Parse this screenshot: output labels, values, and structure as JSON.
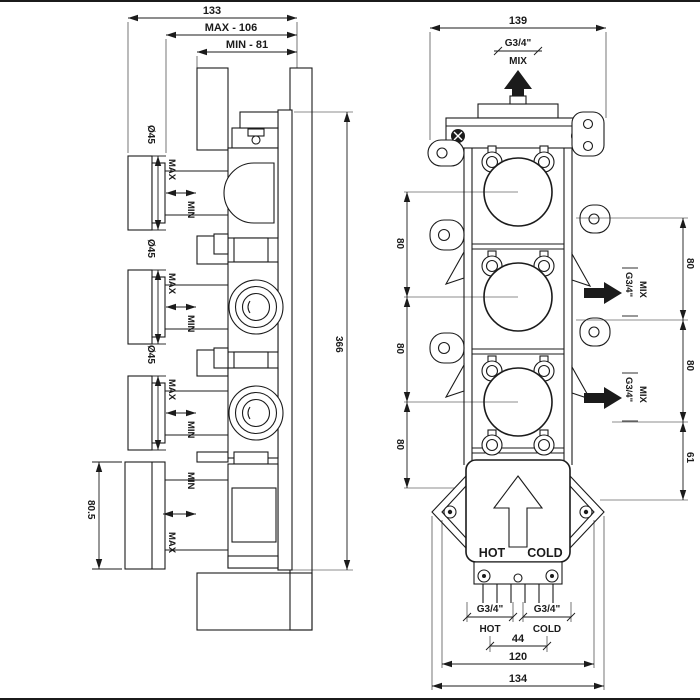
{
  "dims": {
    "overall_depth": "133",
    "depth_max": "MAX - 106",
    "depth_min": "MIN - 81",
    "knob_diameter": "Ø45",
    "body_height": "366",
    "bottom_knob_height": "80.5",
    "body_width": "139",
    "port_spacing": "80",
    "bottom_port_offset": "61",
    "inlet_spacing": "44",
    "mounting_width": "120",
    "overall_width": "134"
  },
  "labels": {
    "max": "MAX",
    "min": "MIN",
    "port_size": "G3/4\"",
    "mix": "MIX",
    "hot": "HOT",
    "cold": "COLD"
  }
}
